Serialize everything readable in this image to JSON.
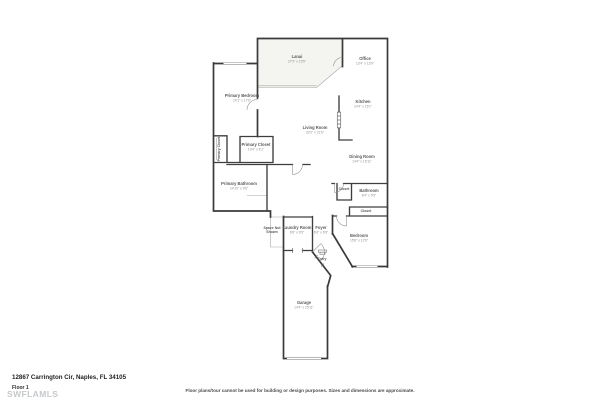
{
  "page": {
    "address": "12867 Carrington Cir, Naples, FL 34105",
    "floor_label": "Floor 1",
    "watermark": "SWFLAMLS",
    "disclaimer": "Floor plans/tour cannot be used for building or design purposes. Sizes and dimensions are approximate."
  },
  "colors": {
    "wall": "#3a3a3c",
    "room_label": "#595a5c",
    "dimension_label": "#909193",
    "lanai_fill": "#f4f4f1",
    "watermark": "#c6c9cb"
  },
  "rooms": [
    {
      "name": "Lanai",
      "dims": "27'9\" x 15'5\"",
      "x": 297,
      "y": 58,
      "rotate": 0,
      "small": false
    },
    {
      "name": "Office",
      "dims": "13'4\" x 13'9\"",
      "x": 365,
      "y": 60,
      "rotate": 0,
      "small": false
    },
    {
      "name": "Primary Bedroom",
      "dims": "14'1\" x 17'6\"",
      "x": 242,
      "y": 97,
      "rotate": 0,
      "small": false
    },
    {
      "name": "Kitchen",
      "dims": "14'4\" x 15'1\"",
      "x": 363,
      "y": 103,
      "rotate": 0,
      "small": false
    },
    {
      "name": "Living Room",
      "dims": "20'2\" x 21'6\"",
      "x": 315,
      "y": 129,
      "rotate": 0,
      "small": false
    },
    {
      "name": "Primary Closet",
      "dims": "10'4\" x 8'1\"",
      "x": 256,
      "y": 146,
      "rotate": 0,
      "small": false
    },
    {
      "name": "Primary Closet",
      "dims": "",
      "x": 220,
      "y": 149,
      "rotate": -90,
      "small": true
    },
    {
      "name": "Dining Room",
      "dims": "14'4\" x 16'11\"",
      "x": 362,
      "y": 158,
      "rotate": 0,
      "small": false
    },
    {
      "name": "Primary Bathroom",
      "dims": "14'10\" x 9'6\"",
      "x": 239,
      "y": 185,
      "rotate": 0,
      "small": false
    },
    {
      "name": "Closet",
      "dims": "",
      "x": 344,
      "y": 190,
      "rotate": 0,
      "small": true
    },
    {
      "name": "Bathroom",
      "dims": "8'4\" x 5'9\"",
      "x": 369,
      "y": 192,
      "rotate": 0,
      "small": false
    },
    {
      "name": "Closet",
      "dims": "",
      "x": 366,
      "y": 212,
      "rotate": 0,
      "small": true
    },
    {
      "name": "Space Not\nShown",
      "dims": "",
      "x": 272,
      "y": 229,
      "rotate": 0,
      "small": true
    },
    {
      "name": "Laundry Room",
      "dims": "6'8\" x 6'5\"",
      "x": 297,
      "y": 229,
      "rotate": 0,
      "small": false
    },
    {
      "name": "Foyer",
      "dims": "6'6\" x 6'9\"",
      "x": 321,
      "y": 229,
      "rotate": 0,
      "small": false
    },
    {
      "name": "Bedroom",
      "dims": "15'8\" x 12'6\"",
      "x": 359,
      "y": 237,
      "rotate": 0,
      "small": false
    },
    {
      "name": "Entry",
      "dims": "",
      "x": 322,
      "y": 260,
      "rotate": 0,
      "small": true
    },
    {
      "name": "Garage",
      "dims": "14'4\" x 25'11\"",
      "x": 304,
      "y": 304,
      "rotate": 0,
      "small": false
    }
  ]
}
